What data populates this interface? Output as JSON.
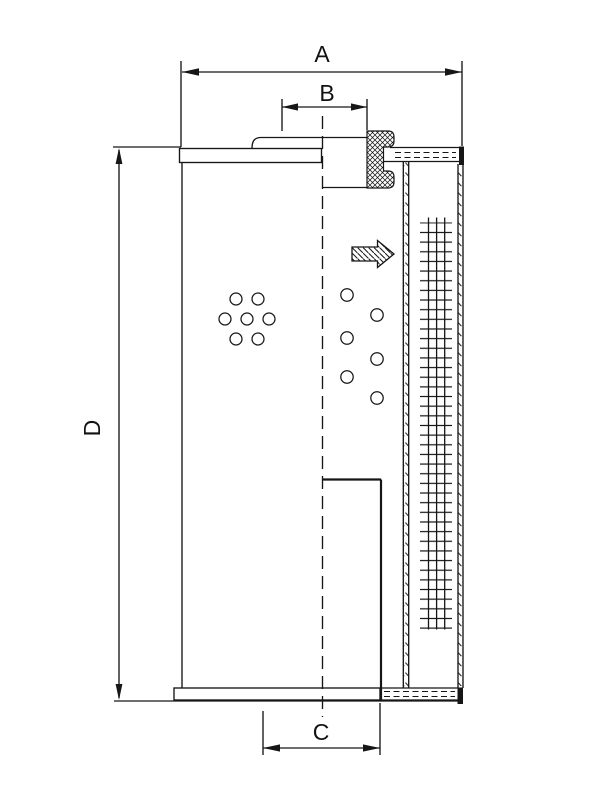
{
  "page": {
    "background": "#ffffff",
    "line_color": "#161616"
  },
  "dimensions": {
    "width_label": "A",
    "top_opening_label": "B",
    "bottom_opening_label": "C",
    "height_label": "D"
  }
}
